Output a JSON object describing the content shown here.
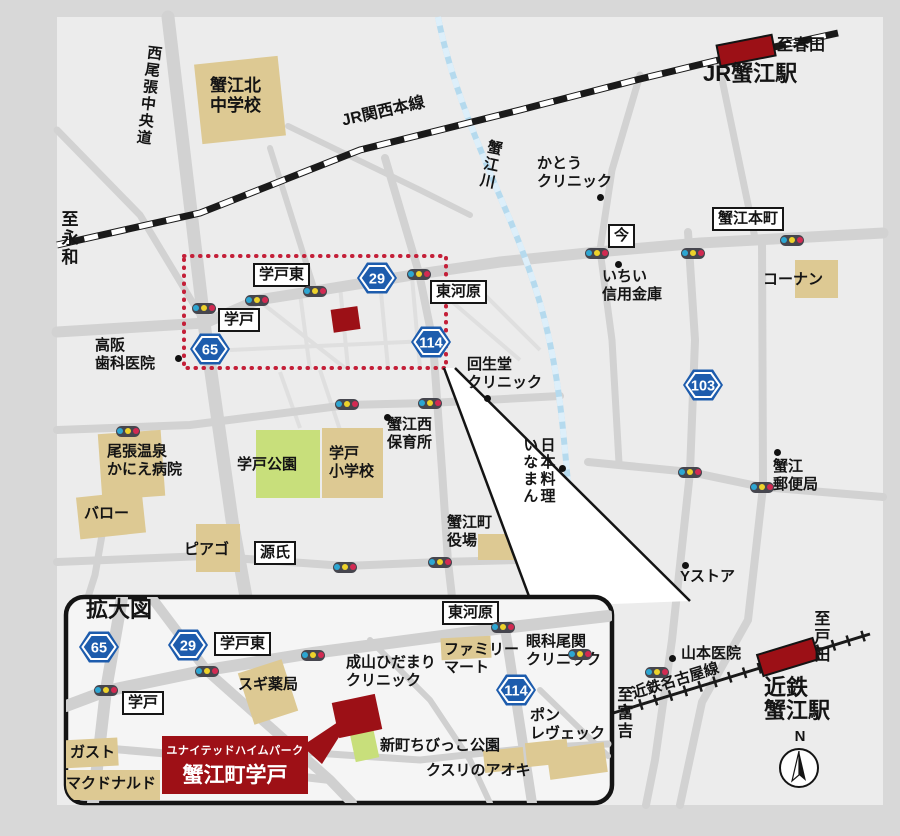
{
  "map": {
    "accent_red": "#9c1016",
    "shield_blue": "#1d5cad",
    "compass": "N",
    "inset": {
      "property": {
        "line1": "ユナイテッドハイムパーク",
        "line2": "蟹江町学戸"
      }
    },
    "labels": [
      {
        "name": "road-nishiowari-chuodo",
        "text": "西尾張中央道",
        "style": "vertical",
        "x": 146,
        "y": 44,
        "rot": 7
      },
      {
        "name": "kanie-kita-junior-high",
        "text": "蟹江北\n中学校",
        "style": "plain",
        "x": 210,
        "y": 76,
        "rot": 0,
        "fs": 17
      },
      {
        "name": "jr-kansai-main-line",
        "text": "JR関西本線",
        "style": "plain",
        "x": 340,
        "y": 112,
        "rot": -13,
        "fs": 16
      },
      {
        "name": "kanie-river",
        "text": "蟹江川",
        "style": "vertical",
        "x": 487,
        "y": 138,
        "rot": 12
      },
      {
        "name": "to-haruta",
        "text": "至春田",
        "style": "plain",
        "x": 777,
        "y": 36,
        "rot": 0,
        "fs": 16
      },
      {
        "name": "jr-kanie-station-label",
        "text": "JR蟹江駅",
        "style": "title",
        "x": 703,
        "y": 62,
        "rot": 0
      },
      {
        "name": "kato-clinic",
        "text": "かとう\nクリニック",
        "style": "plain",
        "x": 537,
        "y": 155,
        "rot": 0
      },
      {
        "name": "ima-intersection",
        "text": "今",
        "style": "boxed",
        "x": 608,
        "y": 224,
        "rot": 0
      },
      {
        "name": "kanie-honmachi-intersection",
        "text": "蟹江本町",
        "style": "boxed",
        "x": 712,
        "y": 207,
        "rot": 0
      },
      {
        "name": "konan-store",
        "text": "コーナン",
        "style": "plain",
        "x": 763,
        "y": 271,
        "rot": 0
      },
      {
        "name": "ichii-shinkin-bank",
        "text": "いちい\n信用金庫",
        "style": "plain",
        "x": 602,
        "y": 268,
        "rot": 0
      },
      {
        "name": "gakuto-higashi-intersection",
        "text": "学戸東",
        "style": "boxed",
        "x": 253,
        "y": 263,
        "rot": 0
      },
      {
        "name": "higashi-kawara-intersection",
        "text": "東河原",
        "style": "boxed",
        "x": 430,
        "y": 280,
        "rot": 0
      },
      {
        "name": "gakuto-intersection",
        "text": "学戸",
        "style": "boxed",
        "x": 218,
        "y": 308,
        "rot": 0
      },
      {
        "name": "takasaka-dental-clinic",
        "text": "高阪\n歯科医院",
        "style": "plain",
        "x": 95,
        "y": 337,
        "rot": 0
      },
      {
        "name": "kaiseido-clinic",
        "text": "回生堂\nクリニック",
        "style": "plain",
        "x": 467,
        "y": 356,
        "rot": 0
      },
      {
        "name": "kanie-nishi-nursery",
        "text": "蟹江西\n保育所",
        "style": "plain",
        "x": 387,
        "y": 416,
        "rot": 0
      },
      {
        "name": "japanese-restaurant-inaman",
        "text": "日本料理\nいなまん",
        "style": "vertical",
        "x": 521,
        "y": 437,
        "rot": 0
      },
      {
        "name": "owari-onsen-kanie-hospital",
        "text": "尾張温泉\nかにえ病院",
        "style": "plain",
        "x": 107,
        "y": 443,
        "rot": 0
      },
      {
        "name": "gakuto-park",
        "text": "学戸公園",
        "style": "plain",
        "x": 237,
        "y": 456,
        "rot": 0
      },
      {
        "name": "gakuto-elementary-school",
        "text": "学戸\n小学校",
        "style": "plain",
        "x": 329,
        "y": 445,
        "rot": 0
      },
      {
        "name": "valor-store",
        "text": "バロー",
        "style": "plain",
        "x": 84,
        "y": 505,
        "rot": 0
      },
      {
        "name": "piago-store",
        "text": "ピアゴ",
        "style": "plain",
        "x": 184,
        "y": 541,
        "rot": 0
      },
      {
        "name": "genji-intersection",
        "text": "源氏",
        "style": "boxed",
        "x": 254,
        "y": 541,
        "rot": 0
      },
      {
        "name": "kanie-town-hall",
        "text": "蟹江町\n役場",
        "style": "plain",
        "x": 447,
        "y": 514,
        "rot": 0
      },
      {
        "name": "kanie-post-office",
        "text": "蟹江\n郵便局",
        "style": "plain",
        "x": 773,
        "y": 458,
        "rot": 0
      },
      {
        "name": "y-store",
        "text": "Yストア",
        "style": "plain",
        "x": 680,
        "y": 568,
        "rot": 0
      },
      {
        "name": "yamamoto-clinic",
        "text": "山本医院",
        "style": "plain",
        "x": 681,
        "y": 645,
        "rot": 0
      },
      {
        "name": "kintetsu-kanie-station-label",
        "text": "近鉄\n蟹江駅",
        "style": "title",
        "x": 764,
        "y": 676,
        "rot": 0
      },
      {
        "name": "to-toda",
        "text": "至戸田",
        "style": "vertical",
        "x": 810,
        "y": 610,
        "rot": 0,
        "fs": 16
      },
      {
        "name": "kintetsu-nagoya-line",
        "text": "近鉄名古屋線",
        "style": "plain",
        "x": 630,
        "y": 686,
        "rot": -17,
        "fs": 15
      },
      {
        "name": "to-tomiyoshi",
        "text": "至富吉",
        "style": "vertical",
        "x": 613,
        "y": 686,
        "rot": 0,
        "fs": 16
      },
      {
        "name": "to-eiwa",
        "text": "至永和",
        "style": "vertical",
        "x": 58,
        "y": 210,
        "rot": 0,
        "fs": 17
      },
      {
        "name": "inset-title",
        "text": "拡大図",
        "style": "title",
        "x": 86,
        "y": 598,
        "rot": 0
      },
      {
        "name": "inset-gakuto-higashi-intersection",
        "text": "学戸東",
        "style": "boxed",
        "x": 214,
        "y": 632,
        "rot": 0
      },
      {
        "name": "inset-higashi-kawara-intersection",
        "text": "東河原",
        "style": "boxed",
        "x": 442,
        "y": 601,
        "rot": 0
      },
      {
        "name": "inset-gakuto-intersection",
        "text": "学戸",
        "style": "boxed",
        "x": 122,
        "y": 691,
        "rot": 0
      },
      {
        "name": "sugi-pharmacy",
        "text": "スギ薬局",
        "style": "plain",
        "x": 238,
        "y": 676,
        "rot": 0
      },
      {
        "name": "naruyama-hidamari-clinic",
        "text": "成山ひだまり\nクリニック",
        "style": "plain",
        "x": 346,
        "y": 654,
        "rot": 0
      },
      {
        "name": "family-mart",
        "text": "ファミリー\nマート",
        "style": "plain",
        "x": 444,
        "y": 641,
        "rot": 0
      },
      {
        "name": "ganka-ozeki-clinic",
        "text": "眼科尾関\nクリニック",
        "style": "plain",
        "x": 526,
        "y": 633,
        "rot": 0
      },
      {
        "name": "pain-lveque-bakery",
        "text": "ポン\nレヴェック",
        "style": "plain",
        "x": 530,
        "y": 707,
        "rot": 0
      },
      {
        "name": "shinmachi-chibikko-park",
        "text": "新町ちびっこ公園",
        "style": "plain",
        "x": 380,
        "y": 737,
        "rot": 0
      },
      {
        "name": "kusuri-no-aoki",
        "text": "クスリのアオキ",
        "style": "plain",
        "x": 426,
        "y": 762,
        "rot": 0
      },
      {
        "name": "gusto-restaurant",
        "text": "ガスト",
        "style": "plain",
        "x": 70,
        "y": 744,
        "rot": 0
      },
      {
        "name": "mcdonalds",
        "text": "マクドナルド",
        "style": "plain",
        "x": 66,
        "y": 775,
        "rot": 0
      }
    ],
    "shields": [
      {
        "number": "65",
        "x": 189,
        "y": 331
      },
      {
        "number": "29",
        "x": 356,
        "y": 260
      },
      {
        "number": "114",
        "x": 410,
        "y": 324
      },
      {
        "number": "103",
        "x": 682,
        "y": 367
      },
      {
        "number": "65",
        "x": 78,
        "y": 629
      },
      {
        "number": "29",
        "x": 167,
        "y": 627
      },
      {
        "number": "114",
        "x": 495,
        "y": 672
      }
    ],
    "signals": [
      {
        "x": 204,
        "y": 308
      },
      {
        "x": 257,
        "y": 300
      },
      {
        "x": 315,
        "y": 291
      },
      {
        "x": 419,
        "y": 274
      },
      {
        "x": 597,
        "y": 253
      },
      {
        "x": 693,
        "y": 253
      },
      {
        "x": 792,
        "y": 240
      },
      {
        "x": 128,
        "y": 431
      },
      {
        "x": 347,
        "y": 404
      },
      {
        "x": 430,
        "y": 403
      },
      {
        "x": 345,
        "y": 567
      },
      {
        "x": 440,
        "y": 562
      },
      {
        "x": 690,
        "y": 472
      },
      {
        "x": 762,
        "y": 487
      },
      {
        "x": 657,
        "y": 672
      },
      {
        "x": 106,
        "y": 690
      },
      {
        "x": 207,
        "y": 671
      },
      {
        "x": 313,
        "y": 655
      },
      {
        "x": 503,
        "y": 627
      },
      {
        "x": 580,
        "y": 654
      }
    ],
    "poi_dots": [
      {
        "x": 600,
        "y": 197
      },
      {
        "x": 618,
        "y": 264
      },
      {
        "x": 178,
        "y": 358
      },
      {
        "x": 487,
        "y": 398
      },
      {
        "x": 387,
        "y": 417
      },
      {
        "x": 562,
        "y": 468
      },
      {
        "x": 777,
        "y": 452
      },
      {
        "x": 685,
        "y": 565
      },
      {
        "x": 672,
        "y": 658
      }
    ]
  }
}
